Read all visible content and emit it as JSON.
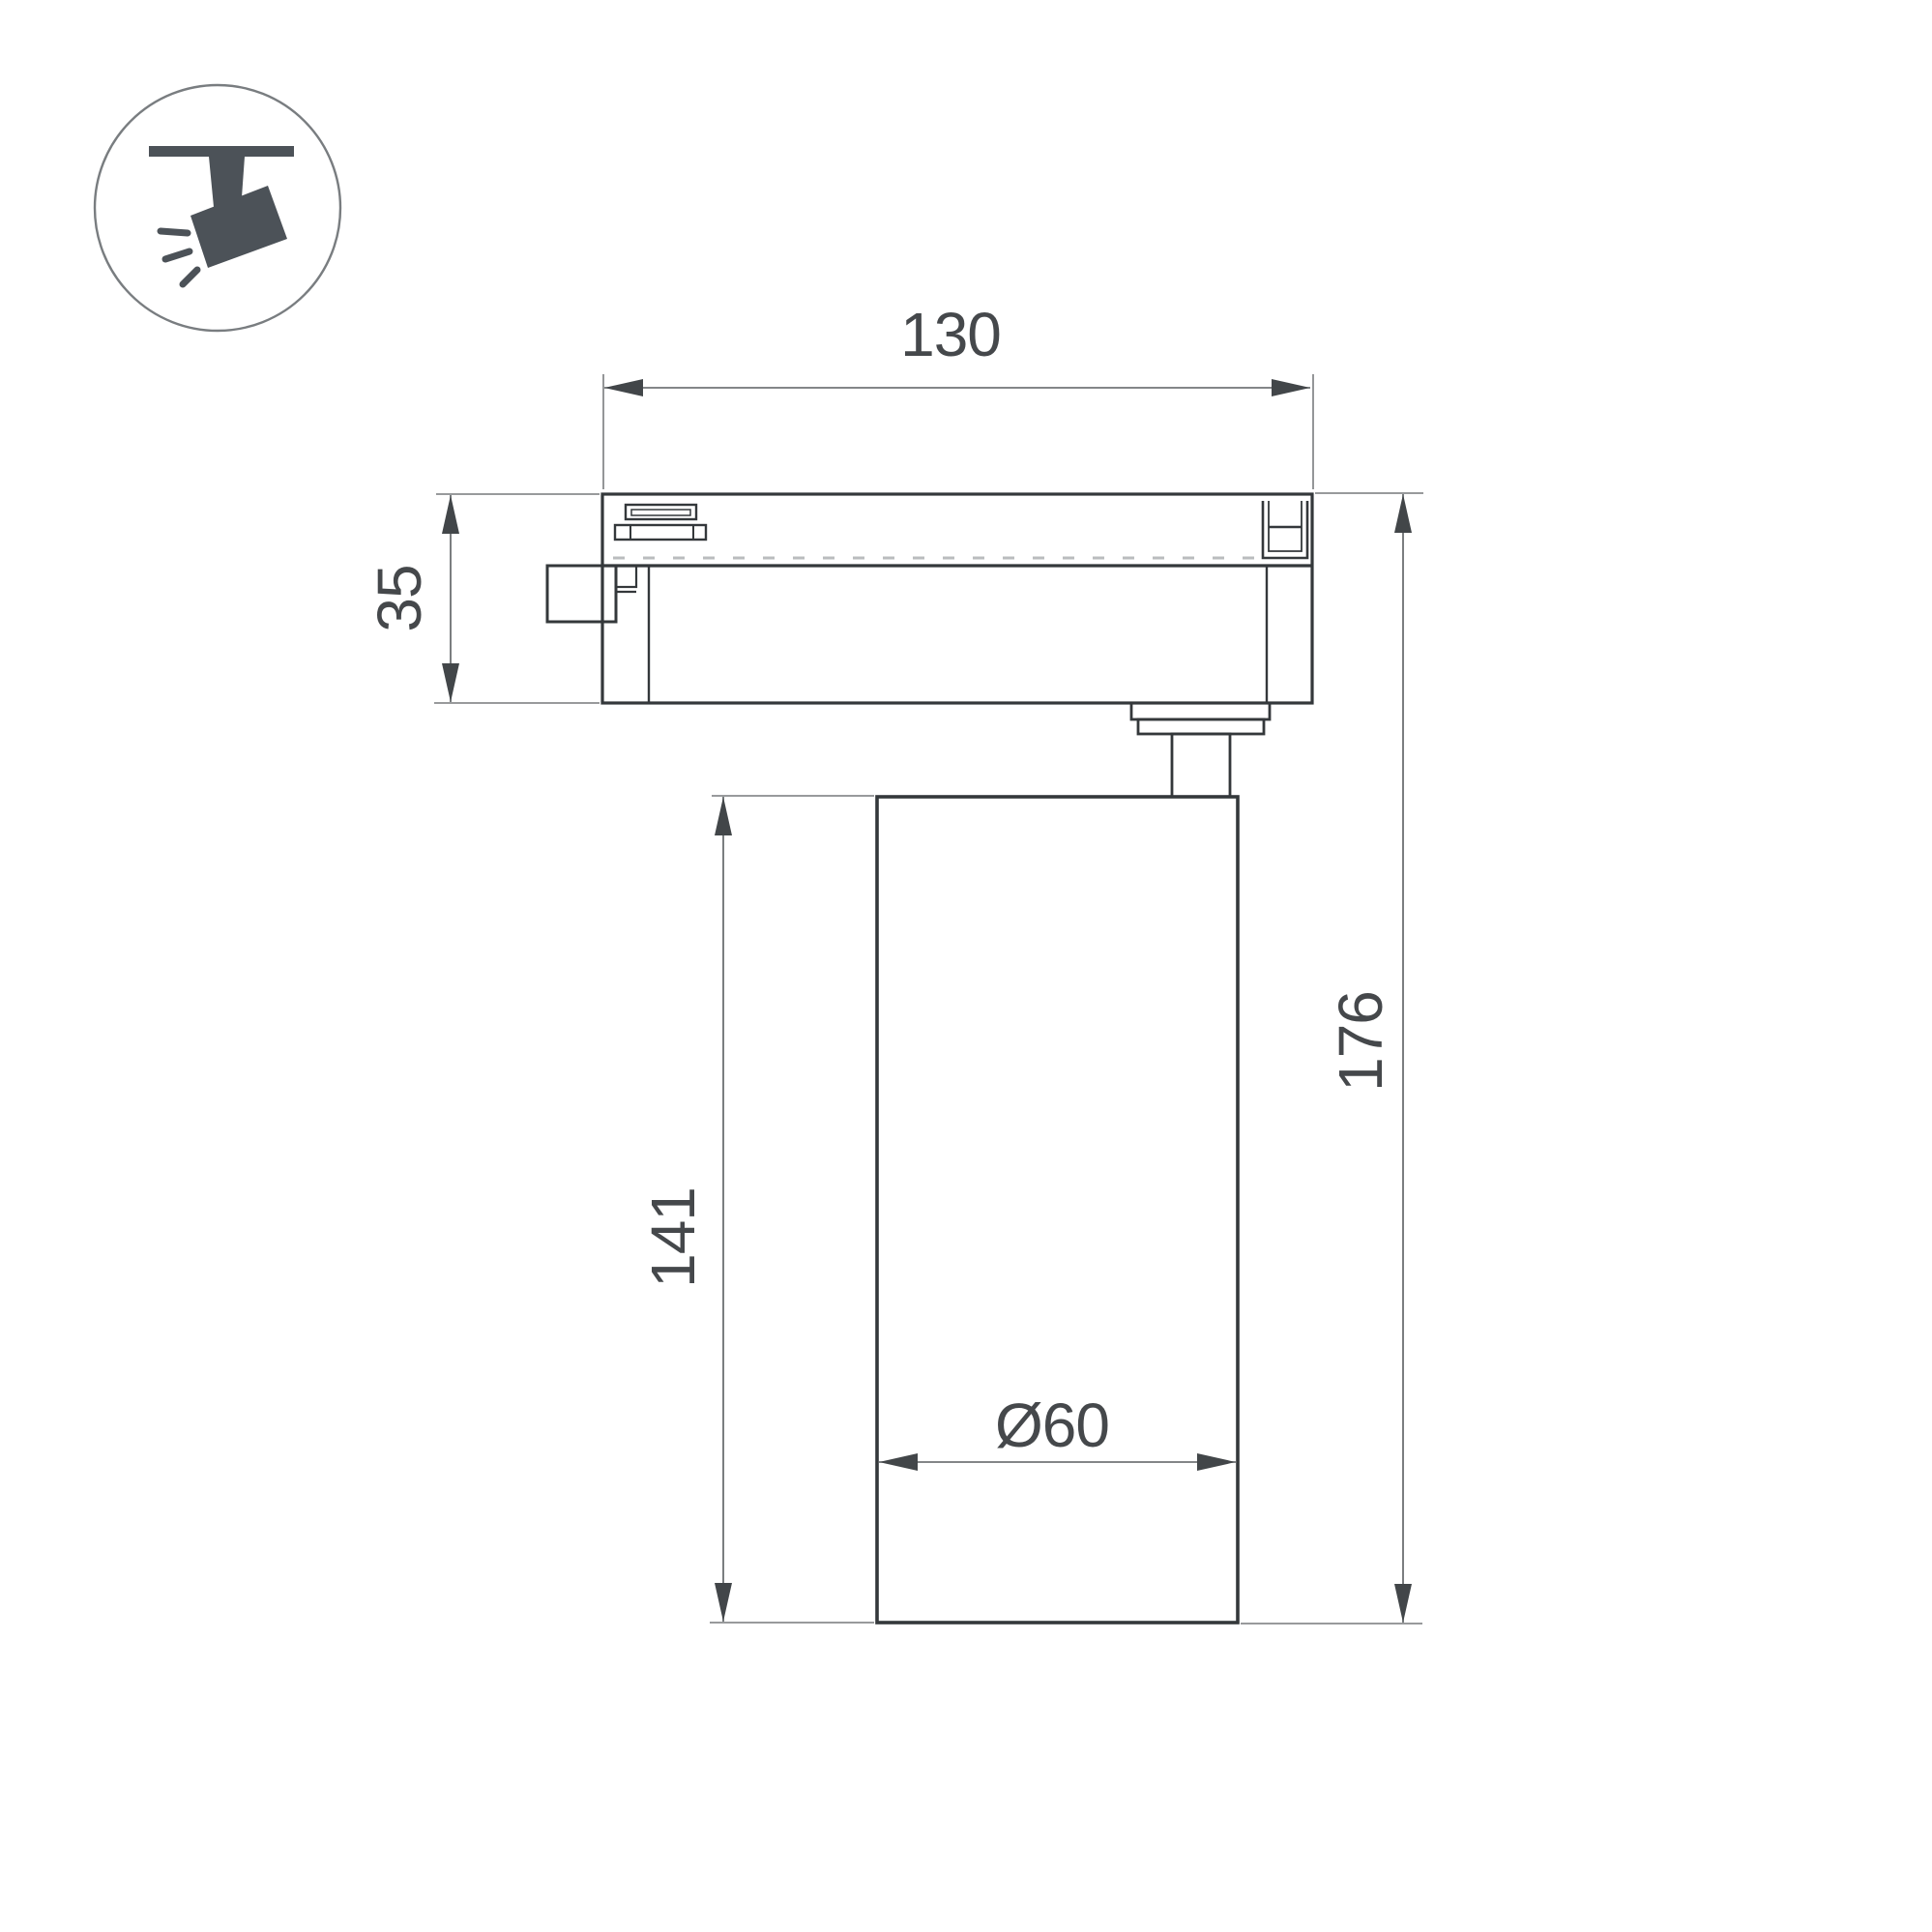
{
  "page": {
    "background": "#ffffff",
    "type_note": "technical dimension drawing of track-mounted spotlight"
  },
  "icon_badge": {
    "icon": "track-spotlight-icon",
    "glyph_color": "#4c5258",
    "circle_stroke_color": "#797d80"
  },
  "drawing": {
    "object_line_color": "#34383b",
    "dimension_line_color": "#5a5e61",
    "arrow_color": "#424649",
    "label_color": "#45484b",
    "tick_color": "#babcbe",
    "labels": {
      "track_width": "130",
      "adapter_height": "35",
      "body_height": "141",
      "total_height": "176",
      "body_diameter": "Ø60"
    }
  }
}
